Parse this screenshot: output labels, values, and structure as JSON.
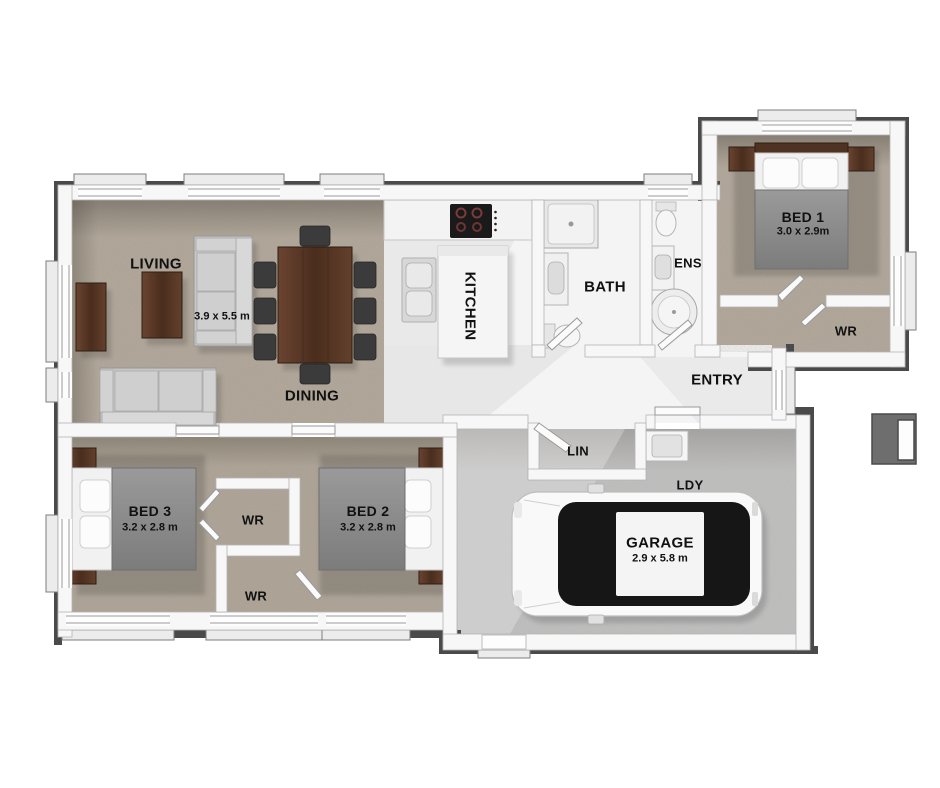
{
  "plan": {
    "type": "residential-floor-plan",
    "colors": {
      "background": "#ffffff",
      "carpet": "#b2a89b",
      "hard_floor": "#f4f4f4",
      "garage_floor": "#bfbfbf",
      "wall_fill": "#f7f7f7",
      "wall_outline": "#4a4a4a",
      "wood": "#5a3a28",
      "sofa_gray": "#c6c6c6",
      "duvet_gray": "#8e8e8e",
      "car_body": "#f9f9f9",
      "glass_black": "#161616",
      "label_color": "#111111"
    },
    "rooms": {
      "living": {
        "label": "LIVING",
        "dims": "3.9 x 5.5 m"
      },
      "dining": {
        "label": "DINING"
      },
      "kitchen": {
        "label": "KITCHEN"
      },
      "bath": {
        "label": "BATH"
      },
      "ens": {
        "label": "ENS"
      },
      "bed1": {
        "label": "BED 1",
        "dims": "3.0 x 2.9m"
      },
      "wr_bed1": {
        "label": "WR"
      },
      "entry": {
        "label": "ENTRY"
      },
      "lin": {
        "label": "LIN"
      },
      "ldy": {
        "label": "LDY"
      },
      "garage": {
        "label": "GARAGE",
        "dims": "2.9 x 5.8 m"
      },
      "bed3": {
        "label": "BED 3",
        "dims": "3.2 x 2.8 m"
      },
      "wr_mid_top": {
        "label": "WR"
      },
      "wr_mid_bottom": {
        "label": "WR"
      },
      "bed2": {
        "label": "BED 2",
        "dims": "3.2 x 2.8 m"
      }
    },
    "furniture": [
      "sofa",
      "sofa-2",
      "coffee-table",
      "tv-unit",
      "dining-table",
      "dining-chairs",
      "kitchen-counter",
      "cooktop",
      "kitchen-island",
      "kitchen-sink",
      "shower",
      "bath-vanity",
      "bath-toilet",
      "ens-toilet",
      "ens-vanity",
      "corner-shower",
      "bed-1",
      "bed-2",
      "bed-3",
      "laundry-tub",
      "car",
      "letterbox"
    ]
  }
}
